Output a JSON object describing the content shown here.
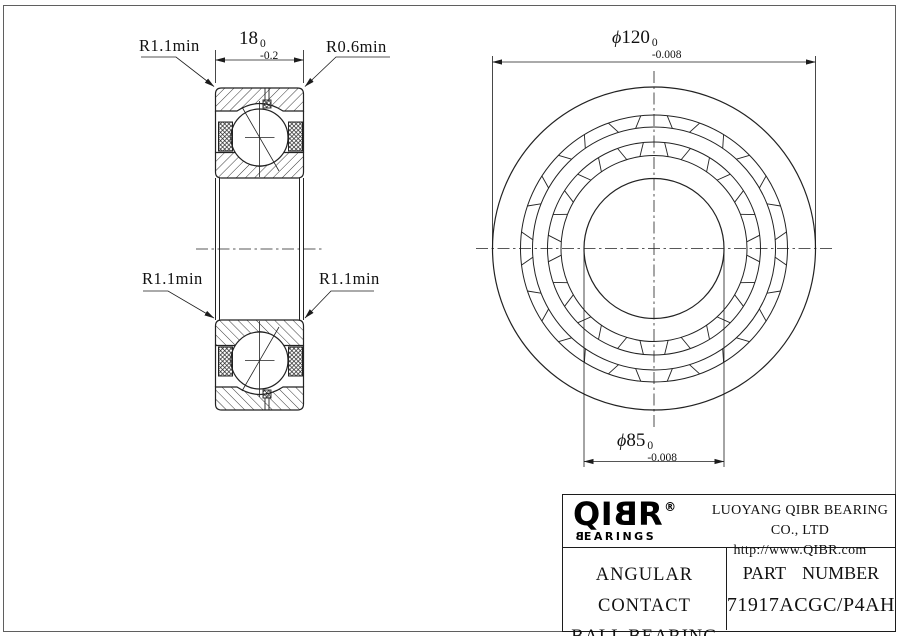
{
  "drawing": {
    "labels": {
      "chamfer_top_left": "R1.1min",
      "chamfer_top_right": "R0.6min",
      "chamfer_mid_left": "R1.1min",
      "chamfer_mid_right": "R1.1min"
    },
    "dims": {
      "width": {
        "value": "18",
        "tol_upper": "0",
        "tol_lower": "-0.2"
      },
      "outer_diameter": {
        "prefix": "ϕ",
        "value": "120",
        "tol_upper": "0",
        "tol_lower": "-0.008"
      },
      "bore_diameter": {
        "prefix": "ϕ",
        "value": "85",
        "tol_upper": "0",
        "tol_lower": "-0.008"
      }
    }
  },
  "title_block": {
    "logo": {
      "text_pre": "QI",
      "text_mirrored_b": "B",
      "text_post": "R",
      "registered_mark": "®",
      "subtitle_mirrored_b": "B",
      "subtitle_rest": "EARINGS"
    },
    "company_name": "LUOYANG QIBR BEARING CO., LTD",
    "website": "http://www.QIBR.com",
    "product_name_line1": "ANGULAR CONTACT",
    "product_name_line2": "BALL BEARING",
    "part_number_label": "PART NUMBER",
    "part_number_value": "71917ACGC/P4AH"
  }
}
